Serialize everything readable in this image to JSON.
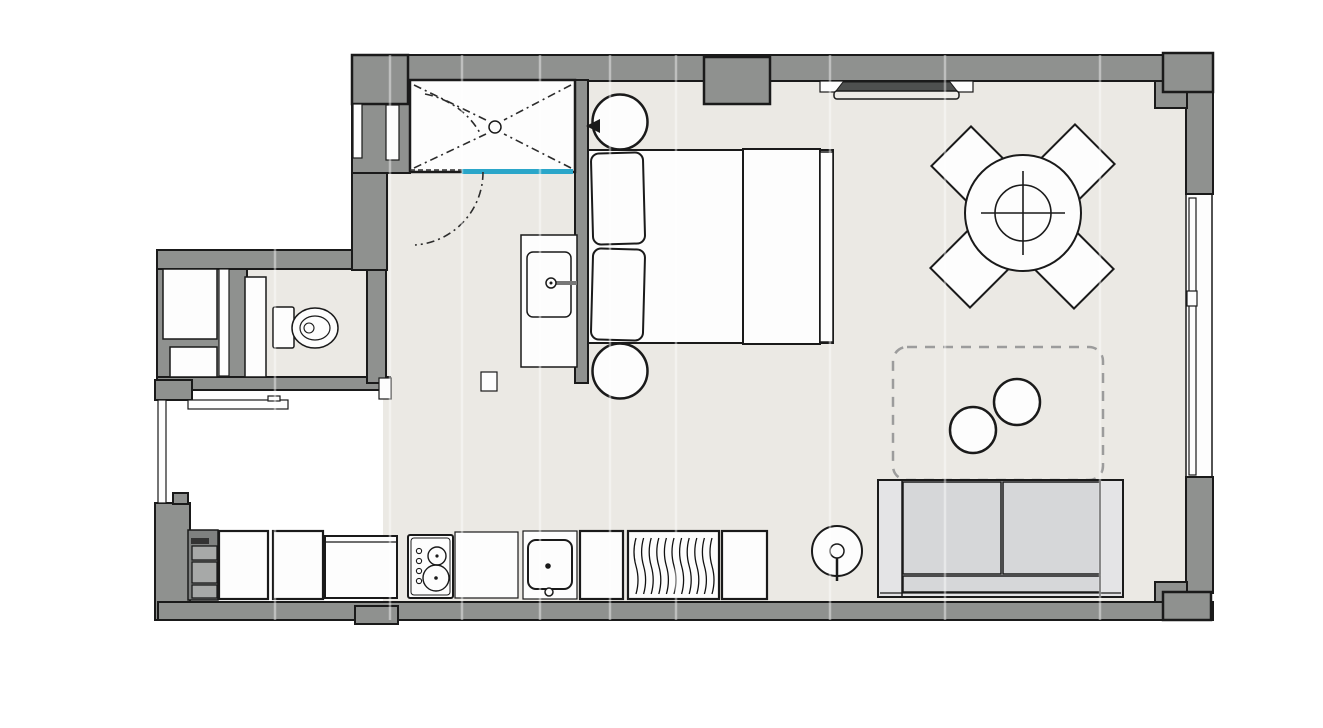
{
  "document": {
    "kind": "architectural-floor-plan",
    "view": "top-down-2d",
    "text_labels": []
  },
  "colors": {
    "background": "#ffffff",
    "floor": "#ebe9e4",
    "wall": "#8f918f",
    "outline": "#1a1a1a",
    "fixture_fill": "#fdfdfd",
    "shower_glass": "#2aa6c9",
    "sofa_cushion": "#d6d7d9",
    "sofa_base": "#e4e4e6",
    "rug_dash": "#9c9c9c",
    "ac_unit": "#4e504f",
    "kitchen_unit_bg": "#7f8180",
    "kitchen_unit_box": "#a7a9a8"
  },
  "rooms": [
    "shower-bathroom",
    "wc-niche",
    "sleeping-area",
    "living-dining-area",
    "kitchenette"
  ],
  "fixtures": {
    "bathroom": [
      "walk-in-shower-tray",
      "shower-drain",
      "glass-panel",
      "double-swing-door",
      "vanity-sink"
    ],
    "wc": [
      "wall-hung-toilet",
      "duct-shaft-boxes",
      "door-leaf",
      "bench-shelf"
    ],
    "sleeping": [
      "double-bed",
      "pillows-x2",
      "duvet-throw",
      "round-nightstand-x2",
      "wall-reading-light"
    ],
    "living_dining": [
      "round-dining-table",
      "dining-chair-x4",
      "wall-ac-unit",
      "area-rug-dashed",
      "round-side-table-x2",
      "two-seat-sofa",
      "floor-lamp",
      "window-right-wall"
    ],
    "kitchen": [
      "shelf-unit",
      "base-cabinet-x4",
      "counter-section-x2",
      "cooktop-2-burner",
      "single-basin-sink",
      "radiator"
    ]
  }
}
